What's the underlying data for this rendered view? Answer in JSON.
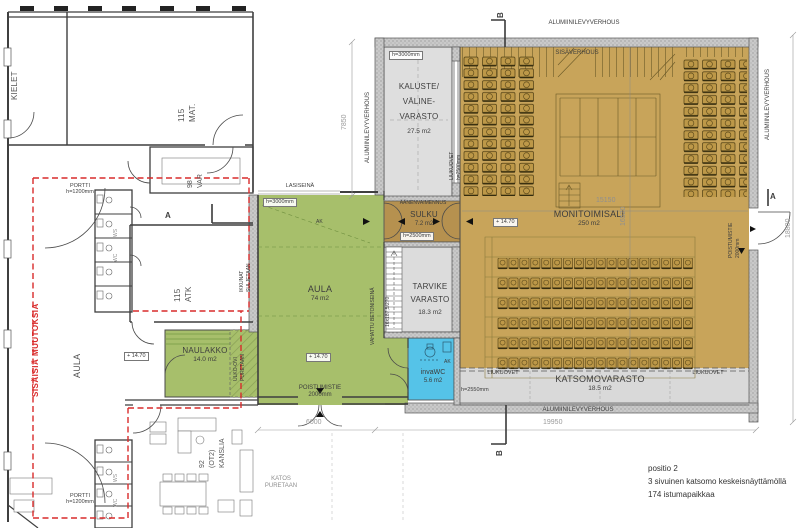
{
  "colors": {
    "aula_green": "#a7bf6b",
    "hall_tan": "#c8a45a",
    "sulku_brown": "#b6914f",
    "invawc_blue": "#55c3e8",
    "room_gray": "#dcdcdc",
    "revision_red": "#d92b2b"
  },
  "left": {
    "kielet": "KIELET",
    "mat1": "115",
    "mat2": "MAT.",
    "var1": "98",
    "var2": "VAR",
    "atk1": "115",
    "atk2": "ATK",
    "aula": "AULA",
    "kanslia1": "92",
    "kanslia2": "(OT2)",
    "kanslia3": "KANSLIA",
    "naulakko": "NAULAKKO",
    "naulakko_area": "14.0 m2",
    "level": "+ 14.70",
    "wc_ws": "WS",
    "wc_wc": "WC",
    "sisaisia": "SISÄISIÄ MUUTOKSIA",
    "portti": "PORTTI",
    "portti_h": "h=1200mm",
    "ulko1": "ULKO-OVI",
    "ulko2": "PURETAAN",
    "ikkunat1": "IKKUNAT",
    "ikkunat2": "SULJETAAN",
    "katos1": "KATOS",
    "katos2": "PURETAAN"
  },
  "aula": {
    "label": "AULA",
    "area": "74 m2",
    "level": "+ 14.70",
    "lasiseina": "LASISEINÄ",
    "h": "h=3000mm",
    "ak": "AK",
    "poistumistie": "POISTUMISTIE",
    "poistumistie_w": "2000mm",
    "vahattu": "VAHATTU BETONISEINÄ",
    "stair": "16x187,5/270"
  },
  "hall": {
    "kaluste1": "KALUSTE/",
    "kaluste2": "VÄLINE-",
    "kaluste3": "VARASTO",
    "kaluste_area": "27.5 m2",
    "kaluste_h": "h=3000mm",
    "liukuovet": "LIUKUOVET",
    "liukuovet_h": "h=2500mm",
    "aanen": "ÄÄNENVAIMENNUS",
    "sulku": "SULKU",
    "sulku_area": "7.2 m2",
    "sulku_h": "h=2500mm",
    "tarvike1": "TARVIKE",
    "tarvike2": "VARASTO",
    "tarvike_area": "18.3 m2",
    "invawc": "invaWC",
    "invawc_area": "5.6 m2",
    "ak": "AK",
    "sali": "MONITOIMISALI",
    "sali_area": "250 m2",
    "level": "+ 14.70",
    "katsomo": "KATSOMOVARASTO",
    "katsomo_area": "18.5 m2",
    "katsomo_h": "h=2550mm",
    "poistumistie": "POISTUMISTIE",
    "poistumistie_w": "2000mm",
    "cladding": "ALUMIINILEVYVERHOUS",
    "sisaverhous": "SISÄVERHOUS"
  },
  "dims": {
    "d7850": "7850",
    "d18800": "18800",
    "d19950": "19950",
    "d6000": "6000",
    "d15150": "15150",
    "d16520": "16520"
  },
  "markers": {
    "a": "A",
    "b": "B"
  },
  "notes": {
    "l1": "positio 2",
    "l2": "3 sivuinen katsomo keskeisnäyttämöllä",
    "l3": "174 istumapaikkaa"
  }
}
